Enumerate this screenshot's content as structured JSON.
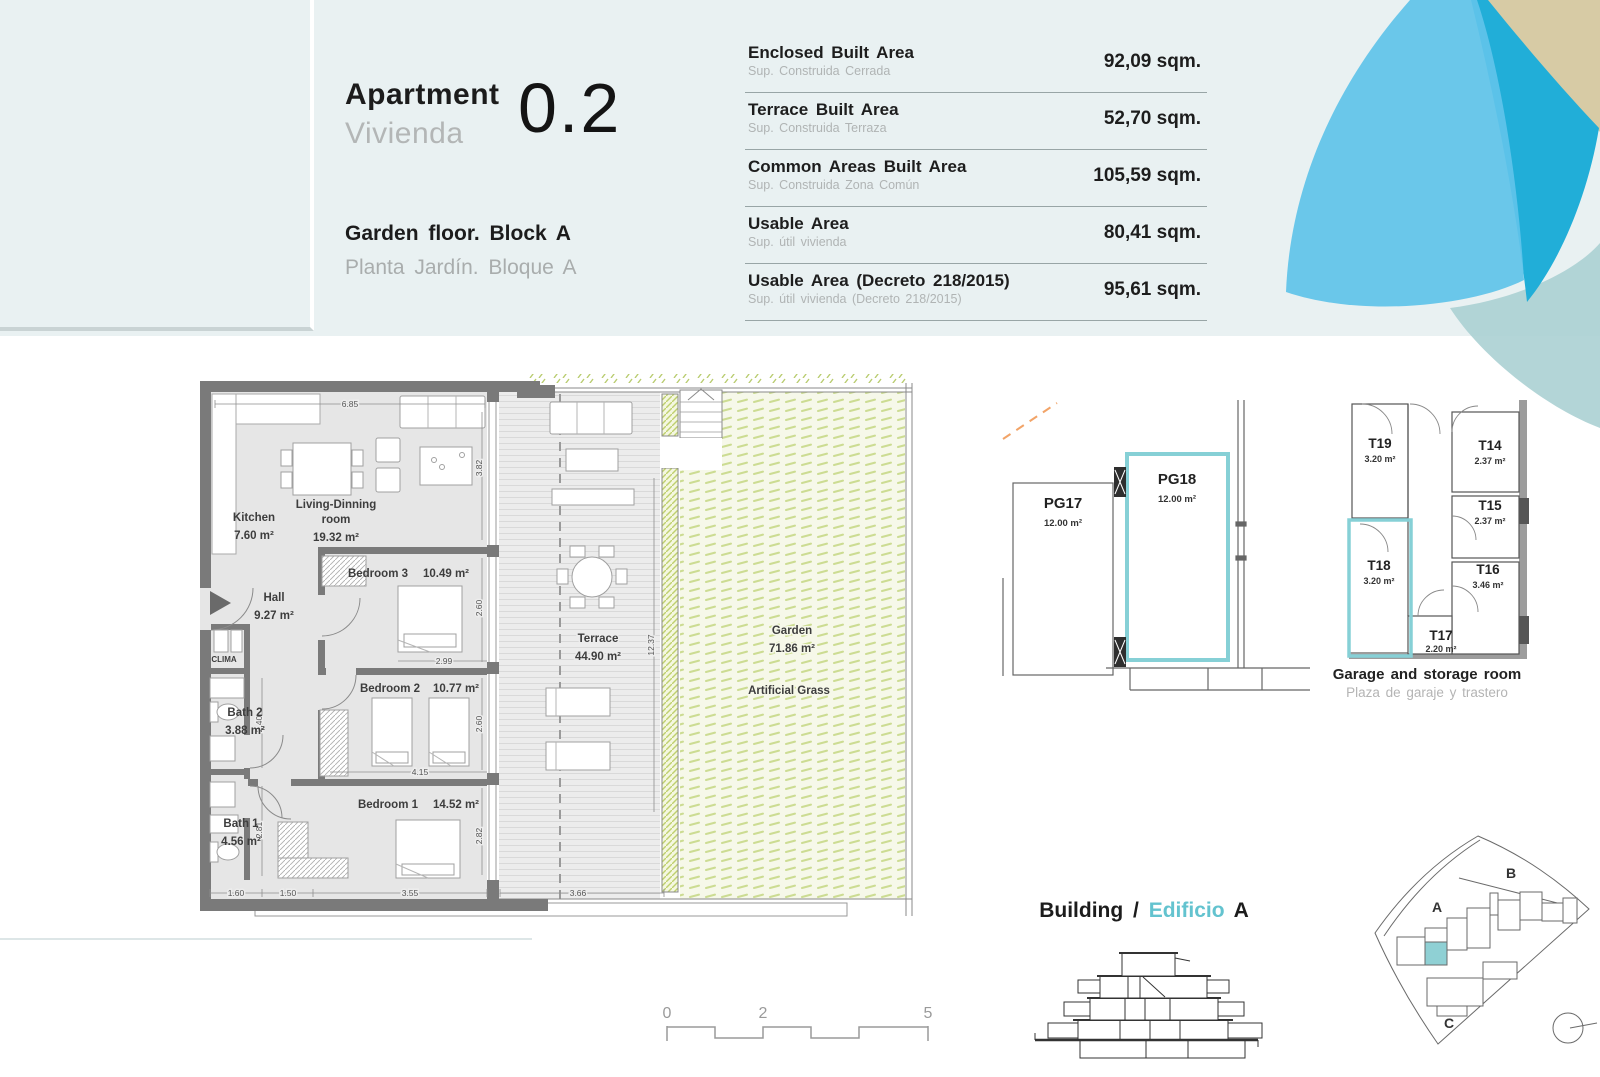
{
  "header": {
    "apartment_label_en": "Apartment",
    "apartment_label_es": "Vivienda",
    "unit_number": "0.2",
    "floor_label_en": "Garden floor. Block A",
    "floor_label_es": "Planta Jardín. Bloque A"
  },
  "area_table": {
    "rows": [
      {
        "label_en": "Enclosed Built Area",
        "label_es": "Sup. Construida Cerrada",
        "value": "92,09 sqm."
      },
      {
        "label_en": "Terrace Built Area",
        "label_es": "Sup. Construida Terraza",
        "value": "52,70 sqm."
      },
      {
        "label_en": "Common Areas Built Area",
        "label_es": "Sup. Construida Zona Común",
        "value": "105,59 sqm."
      },
      {
        "label_en": "Usable Area",
        "label_es": "Sup. útil vivienda",
        "value": "80,41 sqm."
      },
      {
        "label_en": "Usable Area (Decreto 218/2015)",
        "label_es": "Sup. útil vivienda (Decreto 218/2015)",
        "value": "95,61 sqm."
      }
    ]
  },
  "floorplan": {
    "rooms": {
      "kitchen": {
        "name": "Kitchen",
        "area": "7.60 m²"
      },
      "living": {
        "name_line1": "Living-Dinning",
        "name_line2": "room",
        "area": "19.32 m²"
      },
      "hall": {
        "name": "Hall",
        "area": "9.27 m²"
      },
      "clima": {
        "name": "CLIMA"
      },
      "bedroom3": {
        "name": "Bedroom 3",
        "area": "10.49 m²"
      },
      "bedroom2": {
        "name": "Bedroom 2",
        "area": "10.77 m²"
      },
      "bedroom1": {
        "name": "Bedroom 1",
        "area": "14.52 m²"
      },
      "bath2": {
        "name": "Bath 2",
        "area": "3.88 m²"
      },
      "bath1": {
        "name": "Bath 1",
        "area": "4.56 m²"
      },
      "terrace": {
        "name": "Terrace",
        "area": "44.90 m²"
      },
      "garden": {
        "name": "Garden",
        "area": "71.86 m²",
        "surface_note": "Artificial Grass"
      }
    },
    "dimensions": {
      "top_width": "6.85",
      "living_height": "3.82",
      "bed3_height": "2.60",
      "bed3_width": "2.99",
      "bed2_height": "2.60",
      "bed2_width": "4.15",
      "bed1_height": "2.82",
      "bed1_width": "3.55",
      "bottom_1": "1.60",
      "bottom_2": "1.50",
      "bath2_height": "2.40",
      "bath1_height": "2.81",
      "terrace_height": "12.37",
      "terrace_width": "3.66"
    }
  },
  "garage": {
    "pg17": {
      "id": "PG17",
      "area": "12.00 m²"
    },
    "pg18": {
      "id": "PG18",
      "area": "12.00 m²"
    },
    "storage": {
      "t19": {
        "id": "T19",
        "area": "3.20 m²"
      },
      "t18": {
        "id": "T18",
        "area": "3.20 m²"
      },
      "t17": {
        "id": "T17",
        "area": "2.20 m²"
      },
      "t16": {
        "id": "T16",
        "area": "3.46 m²"
      },
      "t15": {
        "id": "T15",
        "area": "2.37 m²"
      },
      "t14": {
        "id": "T14",
        "area": "2.37 m²"
      }
    },
    "caption_en": "Garage and storage room",
    "caption_es": "Plaza de garaje y trastero"
  },
  "building": {
    "label_en": "Building",
    "separator": "/",
    "label_es": "Edificio",
    "block": "A"
  },
  "site_plan": {
    "block_a": "A",
    "block_b": "B",
    "block_c": "C"
  },
  "scale_bar": {
    "ticks": [
      "0",
      "2",
      "5"
    ]
  },
  "colors": {
    "accent_teal": "#7fd2d8",
    "edificio_teal": "#63c3cf",
    "petal_light_blue": "#60c4e9",
    "petal_teal": "#21aed8",
    "petal_tan": "#d7cba5",
    "petal_pale": "#abd0d3",
    "site_highlight": "#8fd0d4",
    "grass_green": "#ccdc92",
    "orange_dash": "#f2a468"
  }
}
